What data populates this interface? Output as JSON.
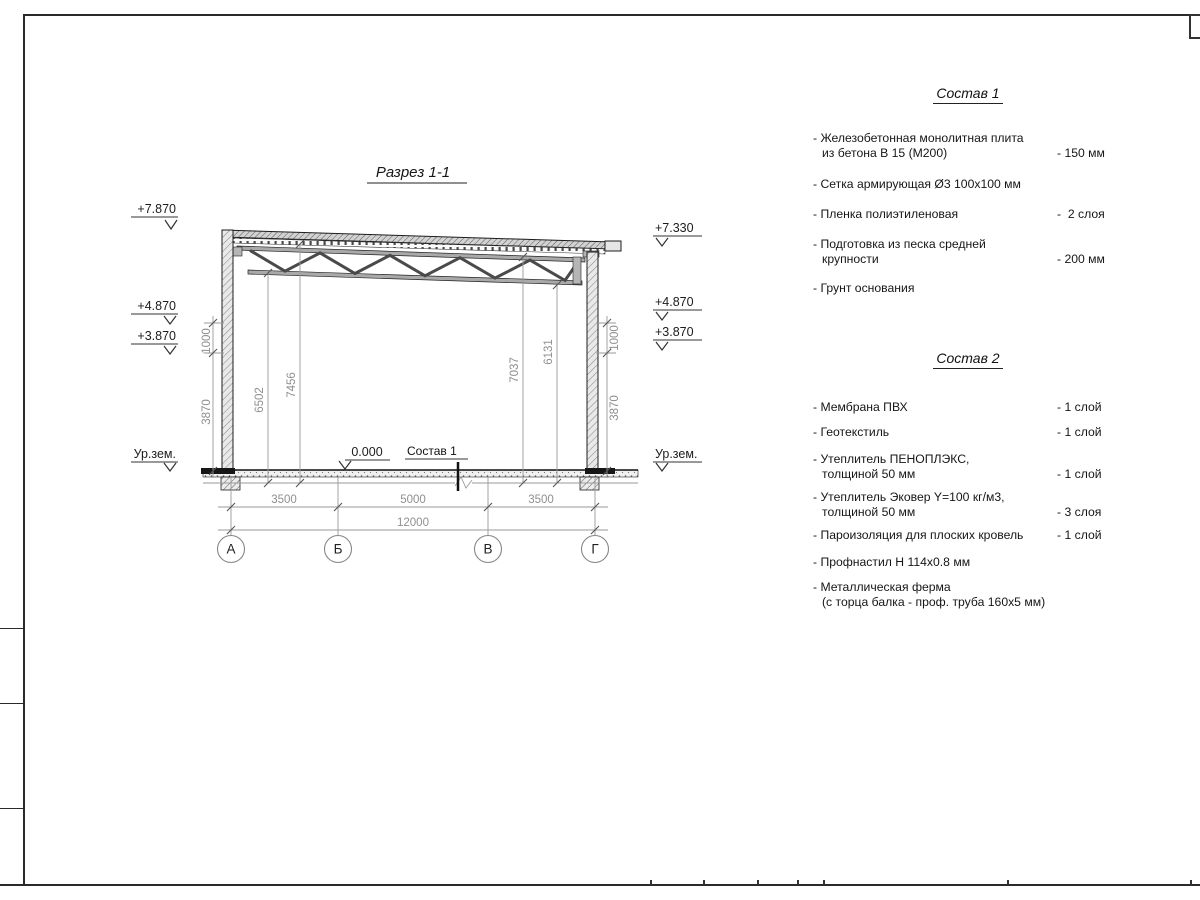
{
  "drawing": {
    "title": "Разрез 1-1",
    "left_marks": {
      "e7870": "+7.870",
      "e4870": "+4.870",
      "e3870": "+3.870",
      "ground": "Ур.зем."
    },
    "right_marks": {
      "e7330": "+7.330",
      "e4870": "+4.870",
      "e3870": "+3.870",
      "ground": "Ур.зем."
    },
    "zero_mark": "0.000",
    "floor_ref": "Состав 1",
    "dims": {
      "d1000": "1000",
      "d3870": "3870",
      "v6502": "6502",
      "v7456": "7456",
      "v7037": "7037",
      "v6131": "6131",
      "b3500": "3500",
      "b5000": "5000",
      "total": "12000"
    },
    "axes": {
      "a": "А",
      "b": "Б",
      "v": "В",
      "g": "Г"
    }
  },
  "sostav1": {
    "title": "Состав 1",
    "items": [
      {
        "l1": "- Железобетонная монолитная плита",
        "l2": "из бетона В 15 (М200)",
        "value": "- 150 мм"
      },
      {
        "l1": "- Сетка армирующая Ø3 100x100 мм",
        "l2": "",
        "value": ""
      },
      {
        "l1": "- Пленка полиэтиленовая",
        "l2": "",
        "value": "-  2 слоя"
      },
      {
        "l1": "- Подготовка из песка средней",
        "l2": "крупности",
        "value": "- 200 мм"
      },
      {
        "l1": "- Грунт основания",
        "l2": "",
        "value": ""
      }
    ]
  },
  "sostav2": {
    "title": "Состав 2",
    "items": [
      {
        "l1": "- Мембрана ПВХ",
        "l2": "",
        "value": "- 1 слой"
      },
      {
        "l1": "- Геотекстиль",
        "l2": "",
        "value": "- 1 слой"
      },
      {
        "l1": "- Утеплитель ПЕНОПЛЭКС,",
        "l2": "толщиной 50 мм",
        "value": "- 1 слой"
      },
      {
        "l1": "- Утеплитель Эковер Y=100 кг/м3,",
        "l2": "толщиной 50 мм",
        "value": "- 3 слоя"
      },
      {
        "l1": "- Пароизоляция для плоских кровель",
        "l2": "",
        "value": "- 1 слой"
      },
      {
        "l1": "- Профнастил Н 114x0.8 мм",
        "l2": "",
        "value": ""
      },
      {
        "l1": "- Металлическая ферма",
        "l2": "(с торца балка - проф. труба 160x5 мм)",
        "value": ""
      }
    ]
  }
}
